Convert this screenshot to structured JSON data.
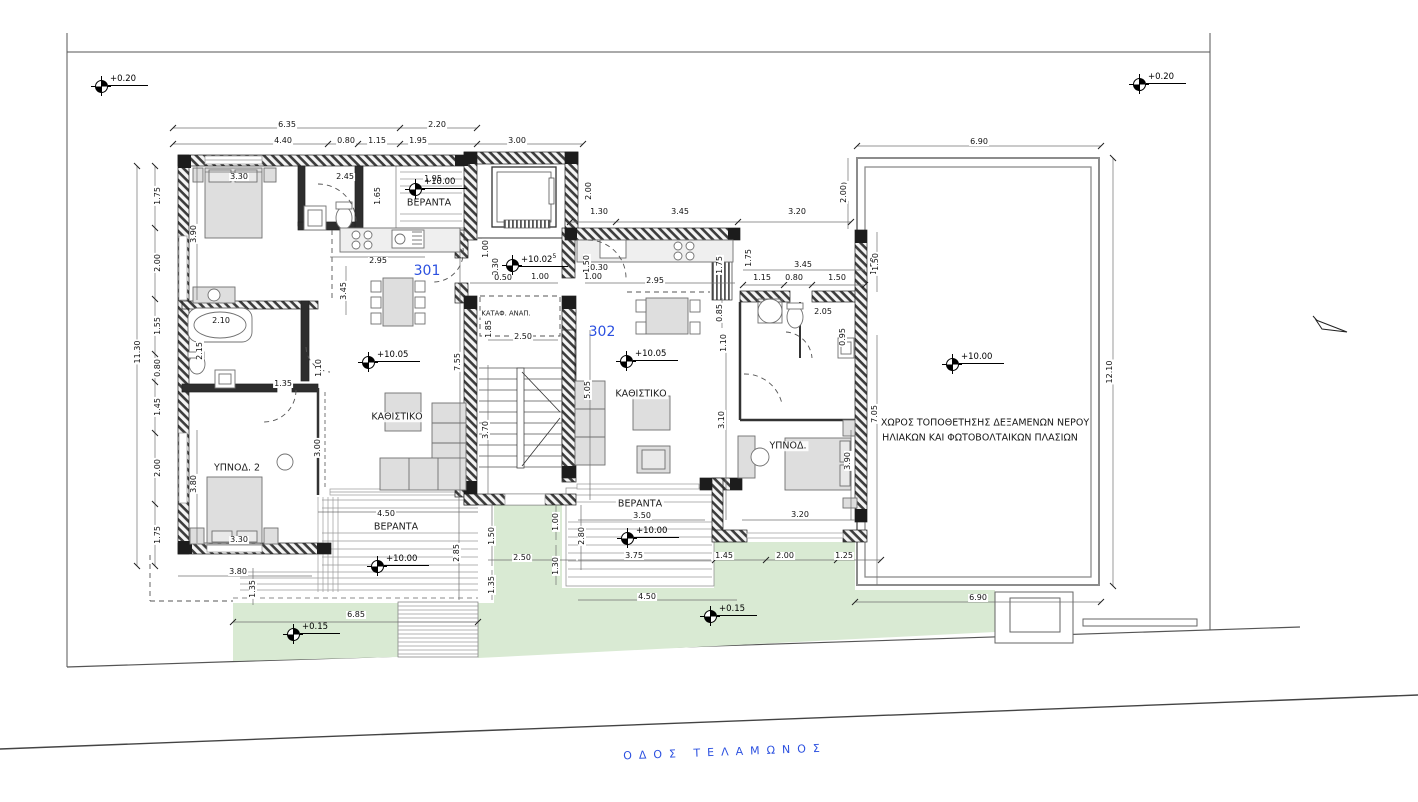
{
  "street": {
    "label": "ΟΔΟΣ ΤΕΛΑΜΩΝΟΣ"
  },
  "units": [
    {
      "label": "301",
      "x": 427,
      "y": 271
    },
    {
      "label": "302",
      "x": 602,
      "y": 332
    }
  ],
  "rooms": [
    {
      "t": "ΒΕΡΑΝΤΑ",
      "x": 429,
      "y": 203
    },
    {
      "t": "ΚΑΘΙΣΤΙΚΟ",
      "x": 397,
      "y": 417
    },
    {
      "t": "ΥΠΝΟΔ. 2",
      "x": 237,
      "y": 468
    },
    {
      "t": "ΒΕΡΑΝΤΑ",
      "x": 396,
      "y": 527
    },
    {
      "t": "ΚΑΘΙΣΤΙΚΟ",
      "x": 641,
      "y": 394
    },
    {
      "t": "ΒΕΡΑΝΤΑ",
      "x": 640,
      "y": 504
    },
    {
      "t": "ΥΠΝΟΔ.",
      "x": 788,
      "y": 446
    },
    {
      "t": "ΚΑΤΑΦ. ΑΝΑΠ.",
      "x": 506,
      "y": 314,
      "small": true
    }
  ],
  "roof_note": {
    "line1": "ΧΩΡΟΣ ΤΟΠΟΘΕΤΗΣΗΣ ΔΕΞΑΜΕΝΩΝ ΝΕΡΟΥ",
    "line2": "ΗΛΙΑΚΩΝ ΚΑΙ ΦΩΤΟΒΟΛΤΑΙΚΩΝ ΠΛΑΣΙΩΝ"
  },
  "levels": [
    {
      "t": "+0.20",
      "x": 101,
      "y": 86
    },
    {
      "t": "+0.20",
      "x": 1139,
      "y": 84
    },
    {
      "t": "+10.00",
      "x": 415,
      "y": 189
    },
    {
      "t": "+10.02",
      "sup": "5",
      "x": 512,
      "y": 265
    },
    {
      "t": "+10.05",
      "x": 368,
      "y": 362
    },
    {
      "t": "+10.05",
      "x": 626,
      "y": 361
    },
    {
      "t": "+10.00",
      "x": 952,
      "y": 364
    },
    {
      "t": "+10.00",
      "x": 377,
      "y": 566
    },
    {
      "t": "+10.00",
      "x": 627,
      "y": 538
    },
    {
      "t": "+0.15",
      "x": 293,
      "y": 634
    },
    {
      "t": "+0.15",
      "x": 710,
      "y": 616
    }
  ],
  "dimensions": [
    {
      "t": "6.35",
      "x": 287,
      "y": 125
    },
    {
      "t": "2.20",
      "x": 437,
      "y": 125
    },
    {
      "t": "4.40",
      "x": 283,
      "y": 141
    },
    {
      "t": "0.80",
      "x": 346,
      "y": 141
    },
    {
      "t": "1.15",
      "x": 377,
      "y": 141
    },
    {
      "t": "1.95",
      "x": 418,
      "y": 141
    },
    {
      "t": "3.00",
      "x": 517,
      "y": 141
    },
    {
      "t": "1.95",
      "x": 433,
      "y": 179
    },
    {
      "t": "1.75",
      "x": 158,
      "y": 196,
      "v": 1
    },
    {
      "t": "2.00",
      "x": 158,
      "y": 263,
      "v": 1
    },
    {
      "t": "1.55",
      "x": 158,
      "y": 326,
      "v": 1
    },
    {
      "t": "0.80",
      "x": 158,
      "y": 368,
      "v": 1
    },
    {
      "t": "1.45",
      "x": 158,
      "y": 407,
      "v": 1
    },
    {
      "t": "2.00",
      "x": 158,
      "y": 468,
      "v": 1
    },
    {
      "t": "1.75",
      "x": 158,
      "y": 535,
      "v": 1
    },
    {
      "t": "11.30",
      "x": 138,
      "y": 352,
      "v": 1
    },
    {
      "t": "3.30",
      "x": 239,
      "y": 177
    },
    {
      "t": "3.90",
      "x": 194,
      "y": 234,
      "v": 1
    },
    {
      "t": "2.45",
      "x": 345,
      "y": 177
    },
    {
      "t": "1.65",
      "x": 378,
      "y": 196,
      "v": 1
    },
    {
      "t": "2.10",
      "x": 221,
      "y": 321
    },
    {
      "t": "2.15",
      "x": 200,
      "y": 351,
      "v": 1
    },
    {
      "t": "1.35",
      "x": 283,
      "y": 384
    },
    {
      "t": "1.10",
      "x": 319,
      "y": 368,
      "v": 1
    },
    {
      "t": "3.00",
      "x": 318,
      "y": 448,
      "v": 1
    },
    {
      "t": "3.80",
      "x": 194,
      "y": 484,
      "v": 1
    },
    {
      "t": "3.30",
      "x": 239,
      "y": 540
    },
    {
      "t": "2.95",
      "x": 378,
      "y": 261
    },
    {
      "t": "3.45",
      "x": 344,
      "y": 291,
      "v": 1
    },
    {
      "t": "7.55",
      "x": 458,
      "y": 362,
      "v": 1
    },
    {
      "t": "4.50",
      "x": 386,
      "y": 514
    },
    {
      "t": "1.00",
      "x": 486,
      "y": 249,
      "v": 1
    },
    {
      "t": "0.30",
      "x": 496,
      "y": 267,
      "v": 1
    },
    {
      "t": "0.50",
      "x": 503,
      "y": 278
    },
    {
      "t": "1.00",
      "x": 540,
      "y": 277
    },
    {
      "t": "1.85",
      "x": 489,
      "y": 329,
      "v": 1
    },
    {
      "t": "2.50",
      "x": 523,
      "y": 337
    },
    {
      "t": "3.70",
      "x": 486,
      "y": 430,
      "v": 1
    },
    {
      "t": "1.50",
      "x": 587,
      "y": 264,
      "v": 1
    },
    {
      "t": "0.30",
      "x": 599,
      "y": 268
    },
    {
      "t": "1.00",
      "x": 593,
      "y": 277
    },
    {
      "t": "2.00",
      "x": 589,
      "y": 191,
      "v": 1
    },
    {
      "t": "1.30",
      "x": 599,
      "y": 212
    },
    {
      "t": "3.45",
      "x": 680,
      "y": 212
    },
    {
      "t": "3.20",
      "x": 797,
      "y": 212
    },
    {
      "t": "2.00",
      "x": 845,
      "y": 191,
      "v": 1
    },
    {
      "t": "2.95",
      "x": 655,
      "y": 281
    },
    {
      "t": "1.75",
      "x": 720,
      "y": 265,
      "v": 1
    },
    {
      "t": "1.75",
      "x": 749,
      "y": 258,
      "v": 1
    },
    {
      "t": "3.45",
      "x": 803,
      "y": 265
    },
    {
      "t": "1.15",
      "x": 762,
      "y": 278
    },
    {
      "t": "0.80",
      "x": 794,
      "y": 278
    },
    {
      "t": "1.50",
      "x": 837,
      "y": 278
    },
    {
      "t": "1.50",
      "x": 874,
      "y": 266,
      "v": 1
    },
    {
      "t": "2.05",
      "x": 823,
      "y": 312
    },
    {
      "t": "0.95",
      "x": 843,
      "y": 337,
      "v": 1
    },
    {
      "t": "0.85",
      "x": 720,
      "y": 313,
      "v": 1
    },
    {
      "t": "1.10",
      "x": 724,
      "y": 343,
      "v": 1
    },
    {
      "t": "5.05",
      "x": 588,
      "y": 390,
      "v": 1
    },
    {
      "t": "3.10",
      "x": 722,
      "y": 420,
      "v": 1
    },
    {
      "t": "3.90",
      "x": 848,
      "y": 461,
      "v": 1
    },
    {
      "t": "3.20",
      "x": 800,
      "y": 515
    },
    {
      "t": "7.05",
      "x": 875,
      "y": 414,
      "v": 1
    },
    {
      "t": "6.90",
      "x": 979,
      "y": 142
    },
    {
      "t": "2.00",
      "x": 844,
      "y": 194,
      "v": 1
    },
    {
      "t": "1.50",
      "x": 876,
      "y": 262,
      "v": 1
    },
    {
      "t": "12.10",
      "x": 1110,
      "y": 372,
      "v": 1
    },
    {
      "t": "6.90",
      "x": 978,
      "y": 598
    },
    {
      "t": "3.80",
      "x": 238,
      "y": 572
    },
    {
      "t": "1.35",
      "x": 253,
      "y": 589,
      "v": 1
    },
    {
      "t": "2.85",
      "x": 457,
      "y": 553,
      "v": 1
    },
    {
      "t": "6.85",
      "x": 356,
      "y": 615
    },
    {
      "t": "1.50",
      "x": 492,
      "y": 536,
      "v": 1
    },
    {
      "t": "1.00",
      "x": 556,
      "y": 522,
      "v": 1
    },
    {
      "t": "2.50",
      "x": 522,
      "y": 558
    },
    {
      "t": "1.30",
      "x": 556,
      "y": 566,
      "v": 1
    },
    {
      "t": "1.35",
      "x": 492,
      "y": 585,
      "v": 1
    },
    {
      "t": "3.50",
      "x": 642,
      "y": 516
    },
    {
      "t": "2.80",
      "x": 582,
      "y": 536,
      "v": 1
    },
    {
      "t": "3.75",
      "x": 634,
      "y": 556
    },
    {
      "t": "1.45",
      "x": 724,
      "y": 556
    },
    {
      "t": "2.00",
      "x": 785,
      "y": 556
    },
    {
      "t": "1.25",
      "x": 844,
      "y": 556
    },
    {
      "t": "4.50",
      "x": 647,
      "y": 597
    }
  ],
  "colors": {
    "accent_blue": "#2b50e0",
    "landscape_green": "#d9ead3",
    "wall_dark": "#3c3c3c"
  }
}
